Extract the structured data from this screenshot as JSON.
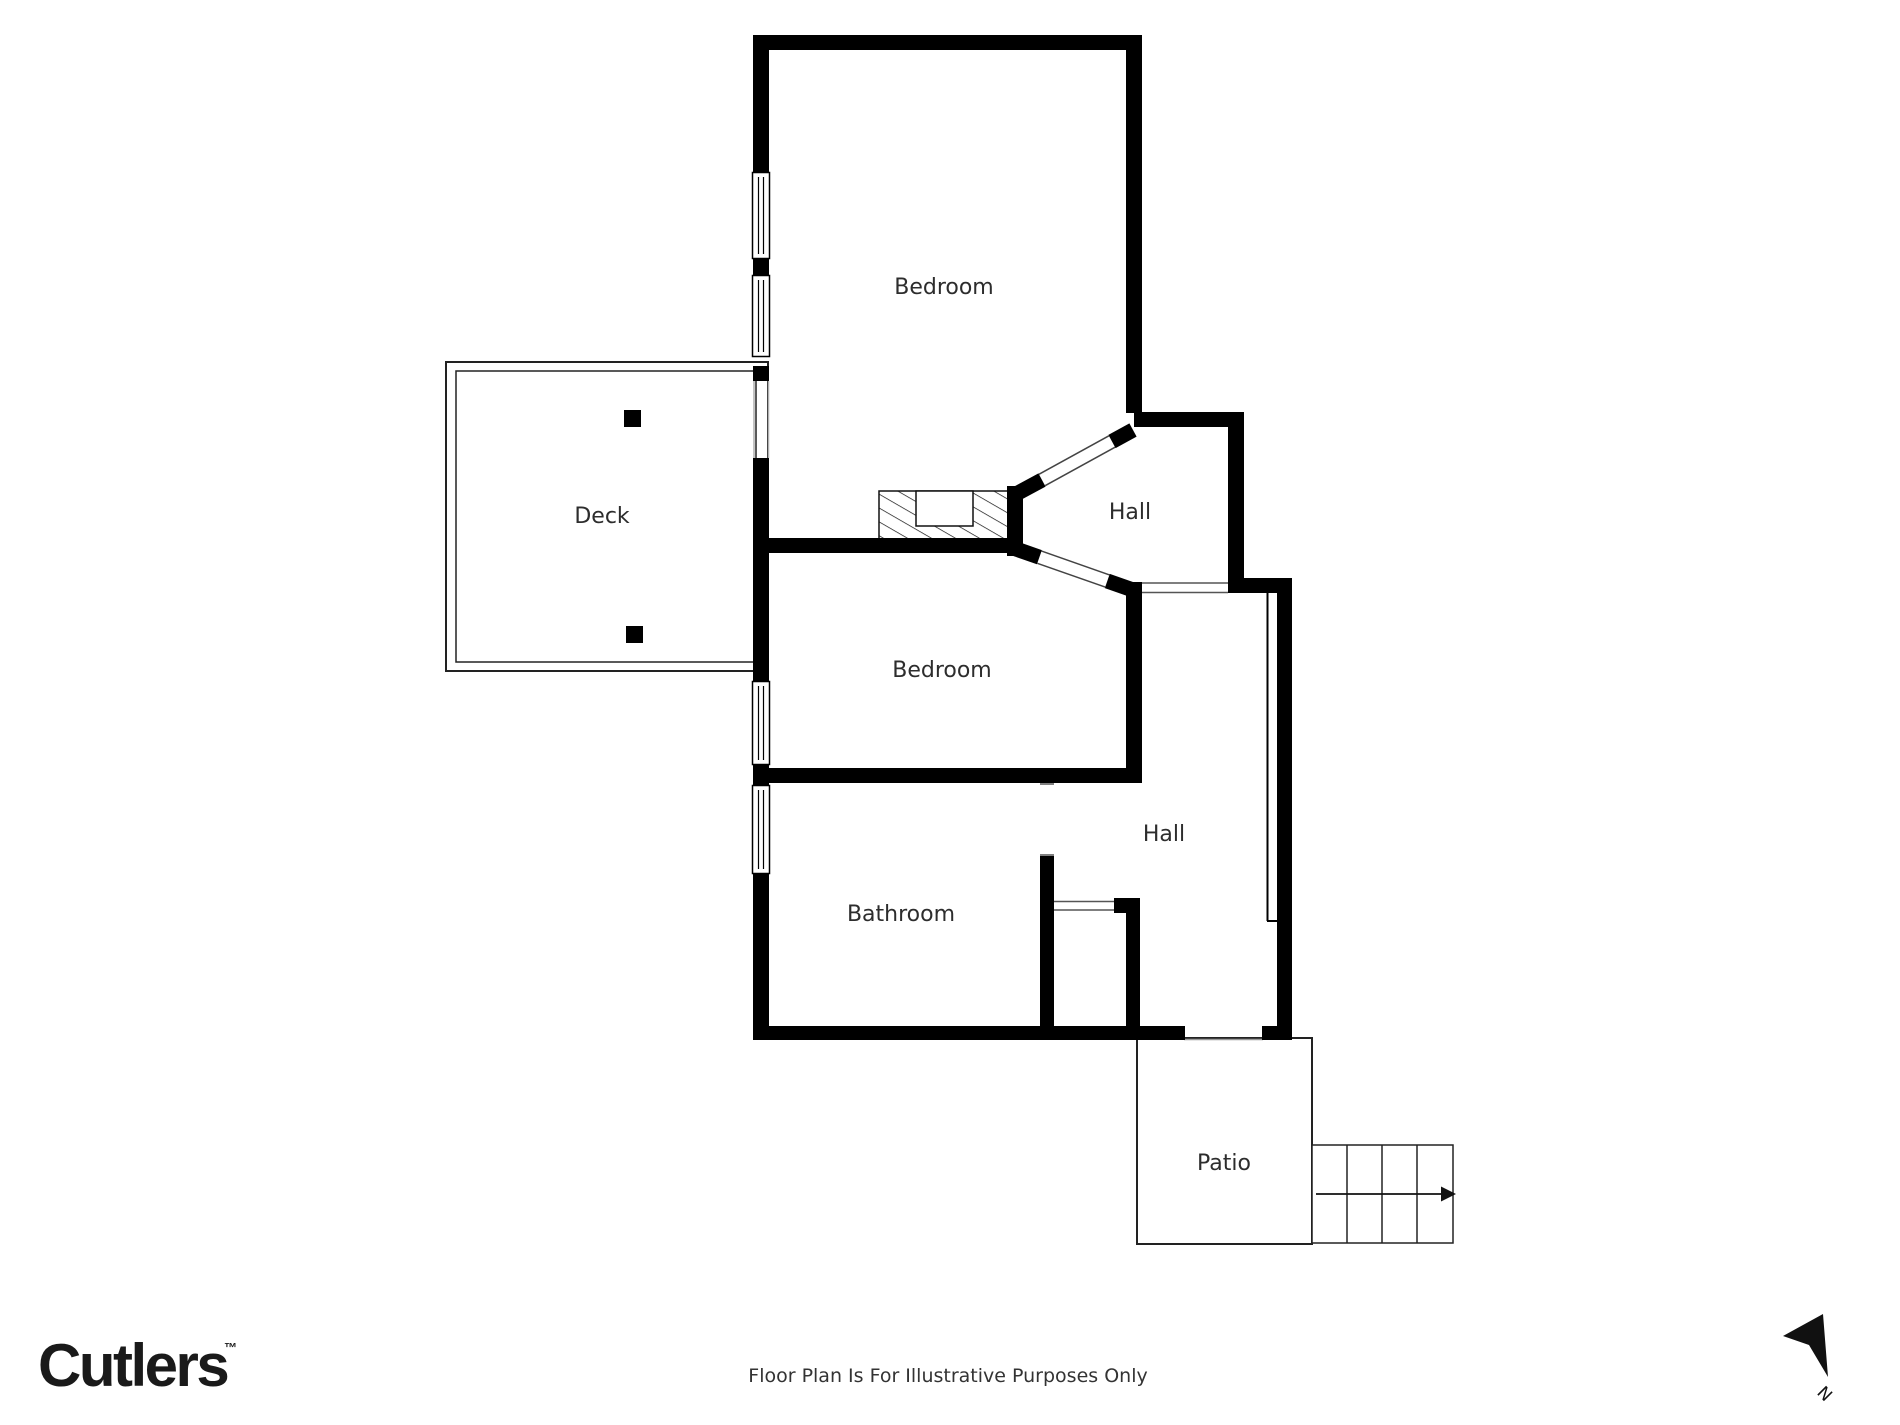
{
  "title": "Floor plan",
  "rooms": [
    {
      "id": "bedroom-1",
      "label": "Bedroom"
    },
    {
      "id": "hall-upper",
      "label": "Hall"
    },
    {
      "id": "deck",
      "label": "Deck"
    },
    {
      "id": "bedroom-2",
      "label": "Bedroom"
    },
    {
      "id": "hall-lower",
      "label": "Hall"
    },
    {
      "id": "bathroom",
      "label": "Bathroom"
    },
    {
      "id": "patio",
      "label": "Patio"
    }
  ],
  "footer": {
    "brand": "Cutlers",
    "trademark": "™",
    "disclaimer": "Floor Plan Is For Illustrative Purposes Only",
    "north_label": "N"
  },
  "colors": {
    "wall": "#000000",
    "thin_line": "#222222",
    "label": "#2d2d2d",
    "background": "#ffffff"
  }
}
